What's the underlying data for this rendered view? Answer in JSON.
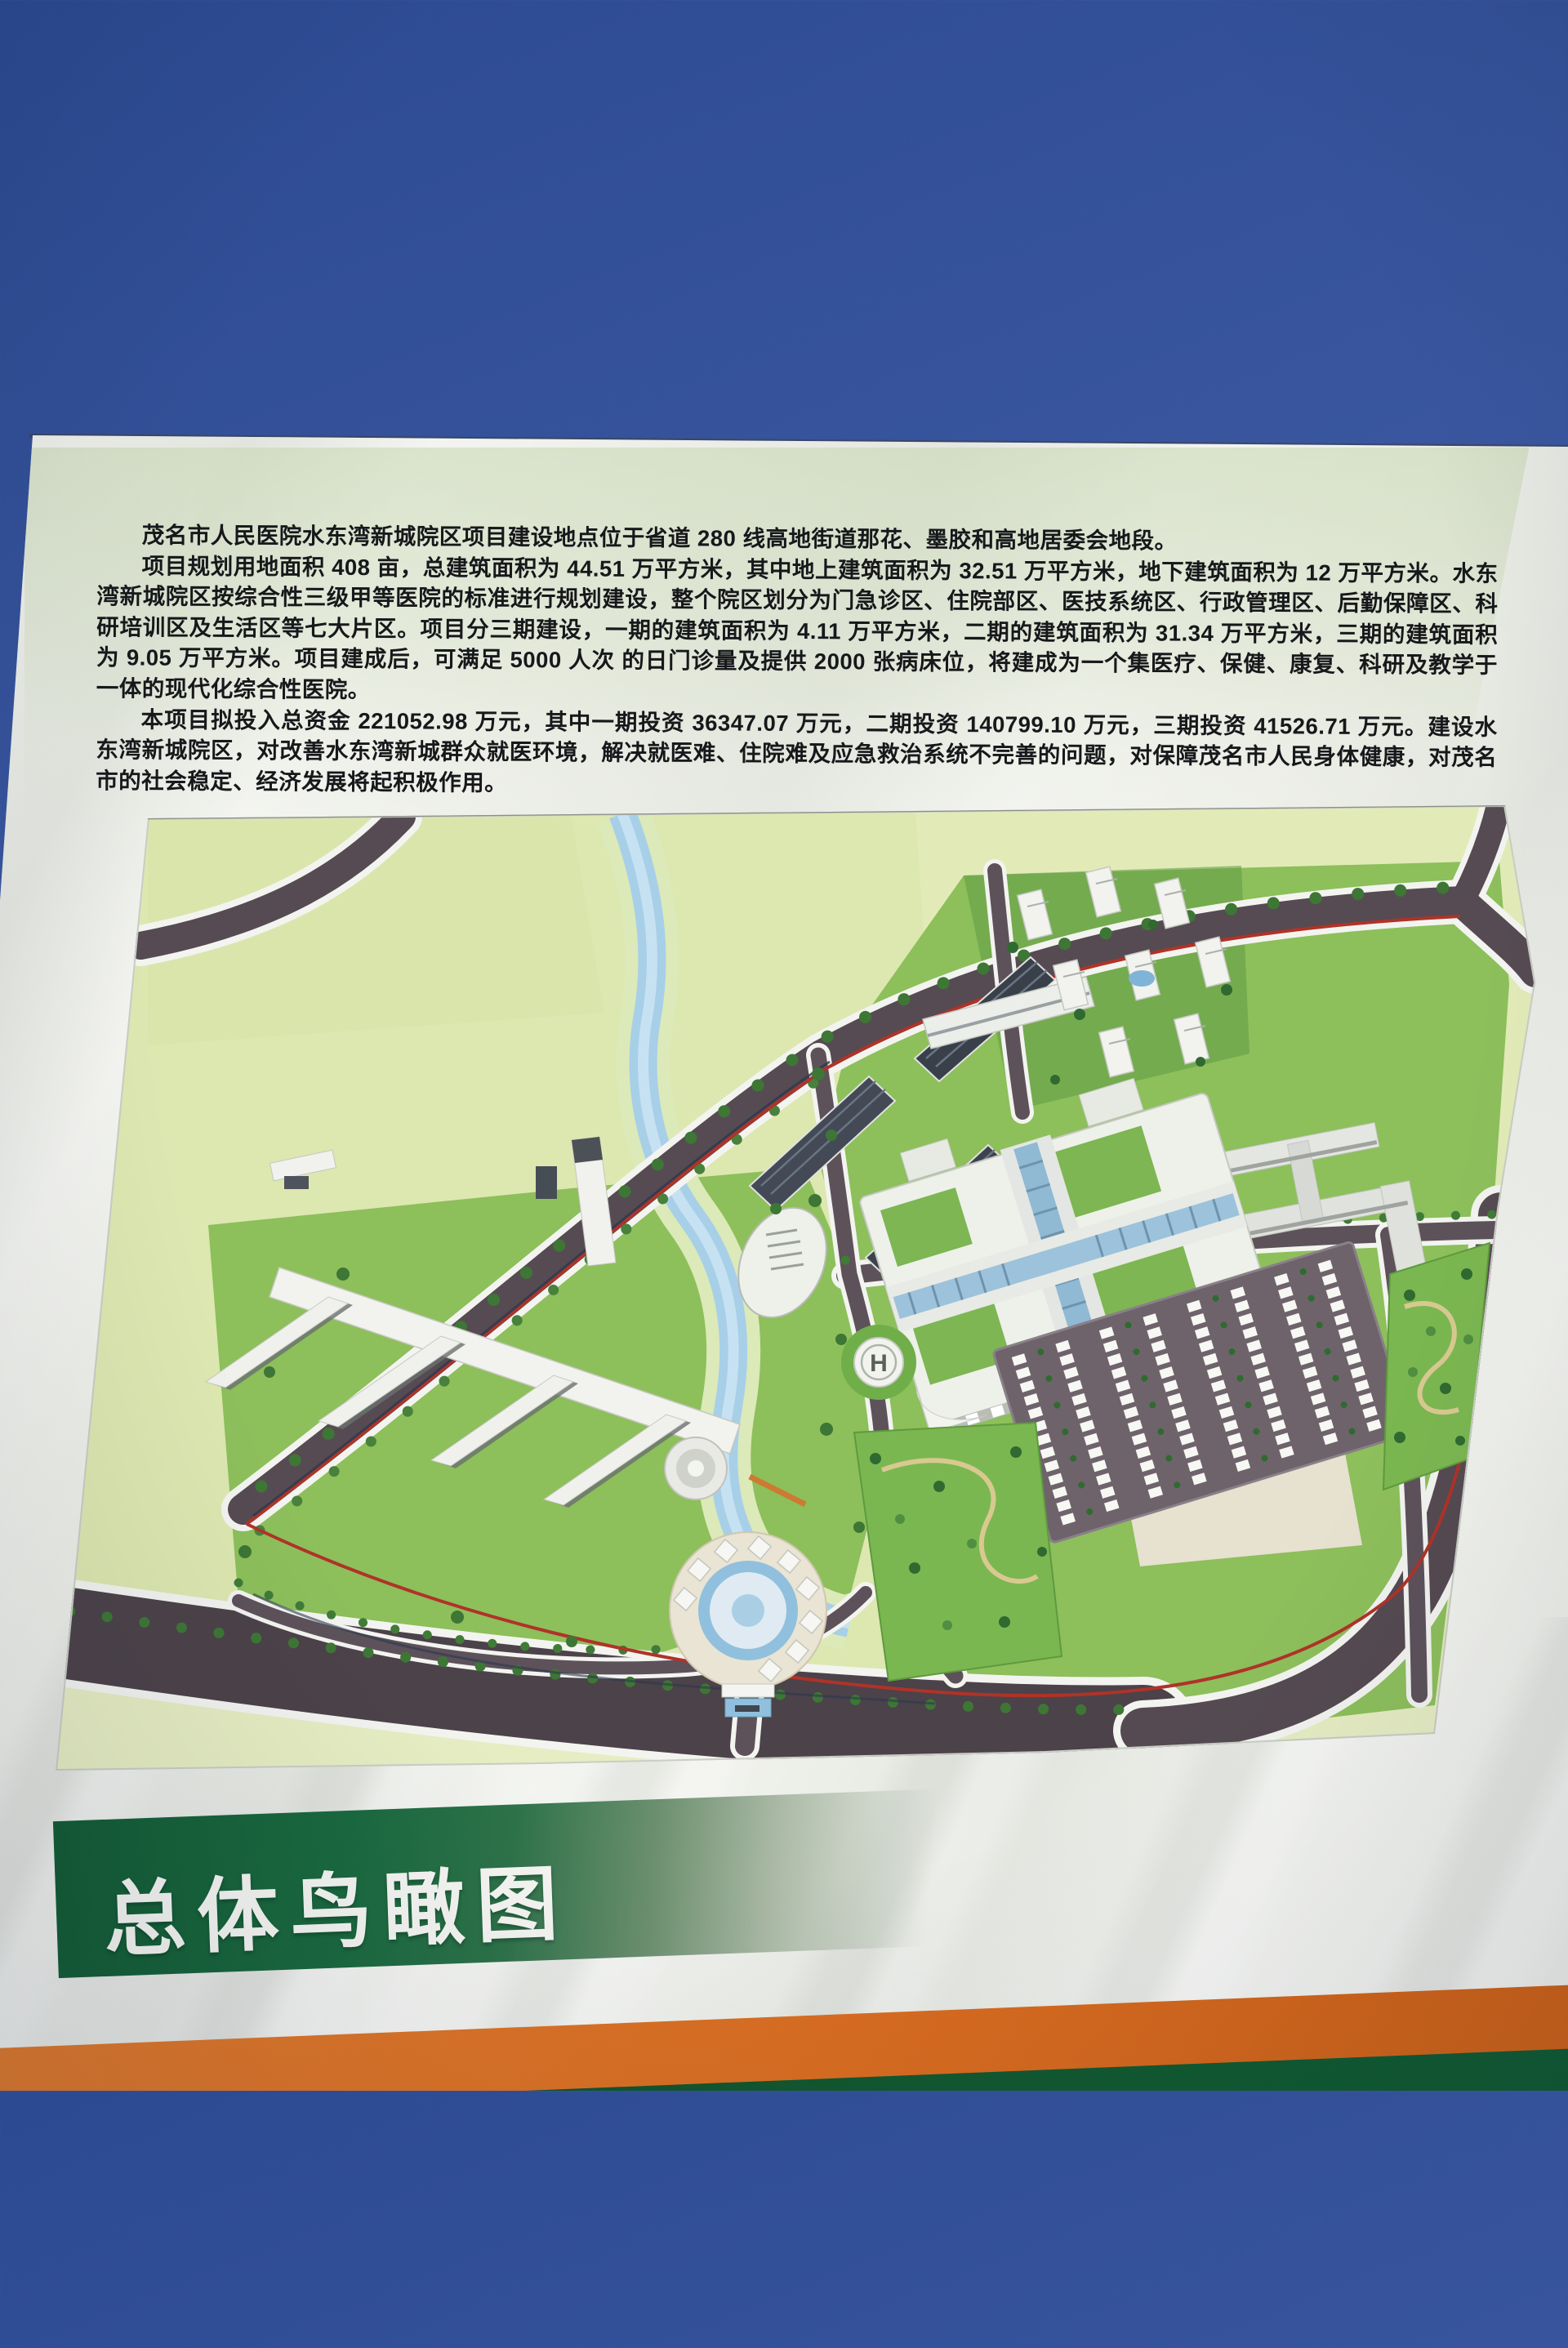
{
  "billboard": {
    "paragraphs": [
      "茂名市人民医院水东湾新城院区项目建设地点位于省道 280 线高地街道那花、墨胶和高地居委会地段。",
      "项目规划用地面积 408 亩，总建筑面积为 44.51 万平方米，其中地上建筑面积为 32.51 万平方米，地下建筑面积为 12 万平方米。水东湾新城院区按综合性三级甲等医院的标准进行规划建设，整个院区划分为门急诊区、住院部区、医技系统区、行政管理区、后勤保障区、科研培训区及生活区等七大片区。项目分三期建设，一期的建筑面积为 4.11 万平方米，二期的建筑面积为 31.34 万平方米，三期的建筑面积为 9.05 万平方米。项目建成后，可满足 5000 人次 的日门诊量及提供 2000 张病床位，将建成为一个集医疗、保健、康复、科研及教学于一体的现代化综合性医院。",
      "本项目拟投入总资金 221052.98 万元，其中一期投资 36347.07 万元，二期投资 140799.10 万元，三期投资 41526.71 万元。建设水东湾新城院区，对改善水东湾新城群众就医环境，解决就医难、住院难及应急救治系统不完善的问题，对保障茂名市人民身体健康，对茂名市的社会稳定、经济发展将起积极作用。"
    ],
    "banner_title": "总体鸟瞰图"
  },
  "drawing": {
    "helipad_label": "H"
  },
  "colors": {
    "sky_top": "#2c4a92",
    "sky_bottom": "#4e6cab",
    "board": "#eff0ea",
    "banner_green": "#17663c",
    "stripe_orange": "#d96f24",
    "stripe_green": "#115930",
    "field": "#dde7af",
    "campus_green": "#8cc058",
    "road": "#564b52",
    "river": "#a6cfe9",
    "accent_red": "#b23227"
  }
}
